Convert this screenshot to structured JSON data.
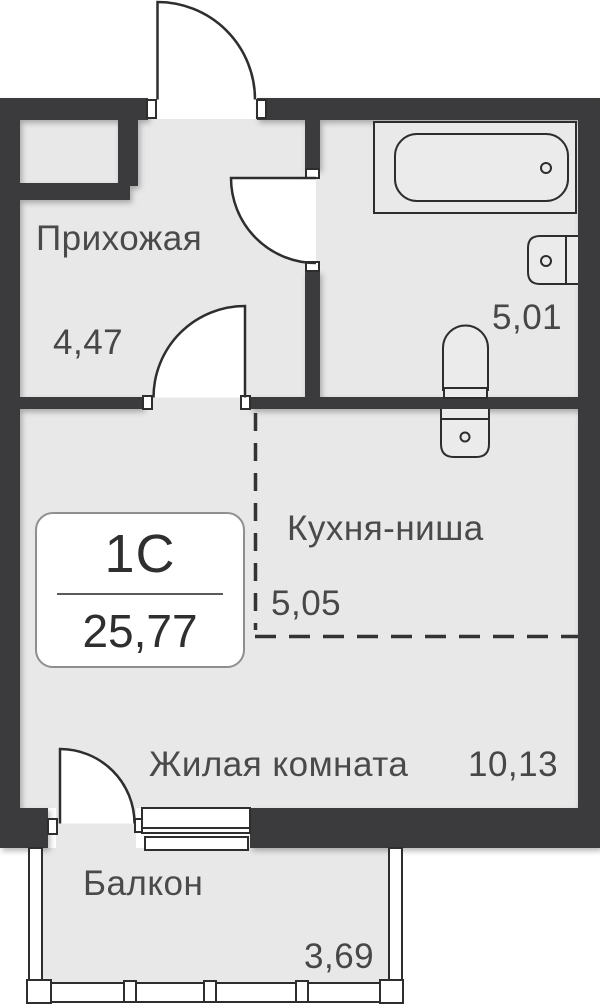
{
  "plan": {
    "badge": {
      "unit_type": "1С",
      "total_area": "25,77"
    },
    "rooms": {
      "hallway": {
        "name": "Прихожая",
        "area": "4,47"
      },
      "bathroom": {
        "area": "5,01"
      },
      "kitchen": {
        "name": "Кухня-ниша",
        "area": "5,05"
      },
      "living": {
        "name": "Жилая комната",
        "area": "10,13"
      },
      "balcony": {
        "name": "Балкон",
        "area": "3,69"
      }
    },
    "colors": {
      "wall": "#3a3a3c",
      "floor": "#e8e8e8",
      "fixture_fill": "#ebebeb",
      "line": "#2e2e2e",
      "text": "#4a4a4a"
    }
  }
}
